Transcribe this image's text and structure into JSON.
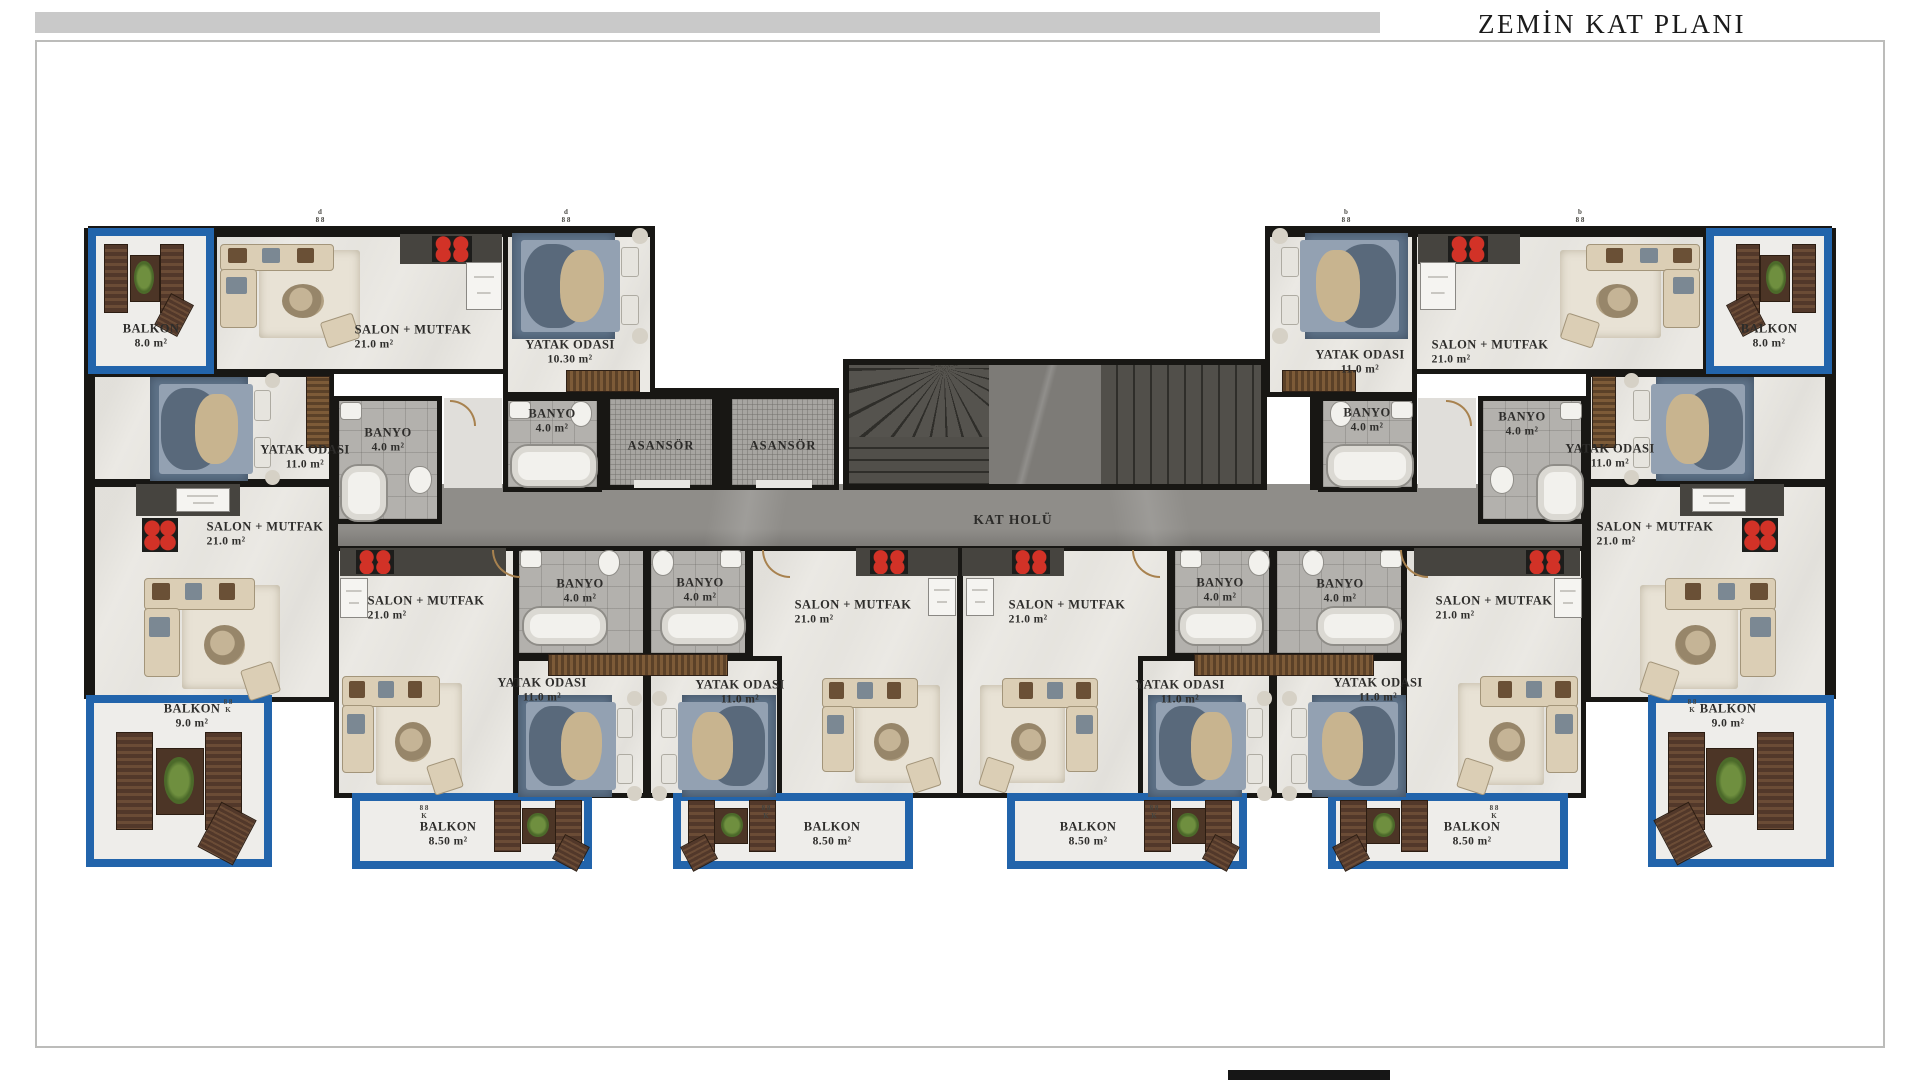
{
  "title": "ZEMİN KAT PLANI",
  "hall_label": "KAT HOLÜ",
  "elevator_label": "ASANSÖR",
  "marks": {
    "top_door_left": "d",
    "top_door_right": "b",
    "pair": "8 8",
    "k": "K"
  },
  "rooms": [
    {
      "id": "a-balkon",
      "name": "BALKON",
      "area": "8.0 m²"
    },
    {
      "id": "a-salon",
      "name": "SALON + MUTFAK",
      "area": "21.0 m²"
    },
    {
      "id": "a-yatak",
      "name": "YATAK ODASI",
      "area": "10.30 m²"
    },
    {
      "id": "a-banyo",
      "name": "BANYO",
      "area": "4.0 m²"
    },
    {
      "id": "b-banyo",
      "name": "BANYO",
      "area": "4.0 m²"
    },
    {
      "id": "b-yatak",
      "name": "YATAK ODASI",
      "area": "11.0 m²"
    },
    {
      "id": "b-salon",
      "name": "SALON + MUTFAK",
      "area": "21.0 m²"
    },
    {
      "id": "b-balkon",
      "name": "BALKON",
      "area": "9.0 m²"
    },
    {
      "id": "c-salon",
      "name": "SALON + MUTFAK",
      "area": "21.0 m²"
    },
    {
      "id": "c-banyo",
      "name": "BANYO",
      "area": "4.0 m²"
    },
    {
      "id": "c-yatak",
      "name": "YATAK ODASI",
      "area": "11.0 m²"
    },
    {
      "id": "c-balkon",
      "name": "BALKON",
      "area": "8.50 m²"
    },
    {
      "id": "d-banyo",
      "name": "BANYO",
      "area": "4.0 m²"
    },
    {
      "id": "d-yatak",
      "name": "YATAK ODASI",
      "area": "11.0 m²"
    },
    {
      "id": "d-salon",
      "name": "SALON + MUTFAK",
      "area": "21.0 m²"
    },
    {
      "id": "d-balkon",
      "name": "BALKON",
      "area": "8.50 m²"
    },
    {
      "id": "dp-salon",
      "name": "SALON + MUTFAK",
      "area": "21.0 m²"
    },
    {
      "id": "dp-banyo",
      "name": "BANYO",
      "area": "4.0 m²"
    },
    {
      "id": "dp-yatak",
      "name": "YATAK ODASI",
      "area": "11.0 m²"
    },
    {
      "id": "dp-balkon",
      "name": "BALKON",
      "area": "8.50 m²"
    },
    {
      "id": "cp-banyo",
      "name": "BANYO",
      "area": "4.0 m²"
    },
    {
      "id": "cp-yatak",
      "name": "YATAK ODASI",
      "area": "11.0 m²"
    },
    {
      "id": "cp-salon",
      "name": "SALON + MUTFAK",
      "area": "21.0 m²"
    },
    {
      "id": "cp-balkon",
      "name": "BALKON",
      "area": "8.50 m²"
    },
    {
      "id": "ap-yatak",
      "name": "YATAK ODASI",
      "area": "11.0 m²"
    },
    {
      "id": "ap-banyo",
      "name": "BANYO",
      "area": "4.0 m²"
    },
    {
      "id": "ap-salon",
      "name": "SALON + MUTFAK",
      "area": "21.0 m²"
    },
    {
      "id": "ap-balkon",
      "name": "BALKON",
      "area": "8.0 m²"
    },
    {
      "id": "bp-banyo",
      "name": "BANYO",
      "area": "4.0 m²"
    },
    {
      "id": "bp-yatak",
      "name": "YATAK ODASI",
      "area": "11.0 m²"
    },
    {
      "id": "bp-salon",
      "name": "SALON + MUTFAK",
      "area": "21.0 m²"
    },
    {
      "id": "bp-balkon",
      "name": "BALKON",
      "area": "9.0 m²"
    }
  ]
}
